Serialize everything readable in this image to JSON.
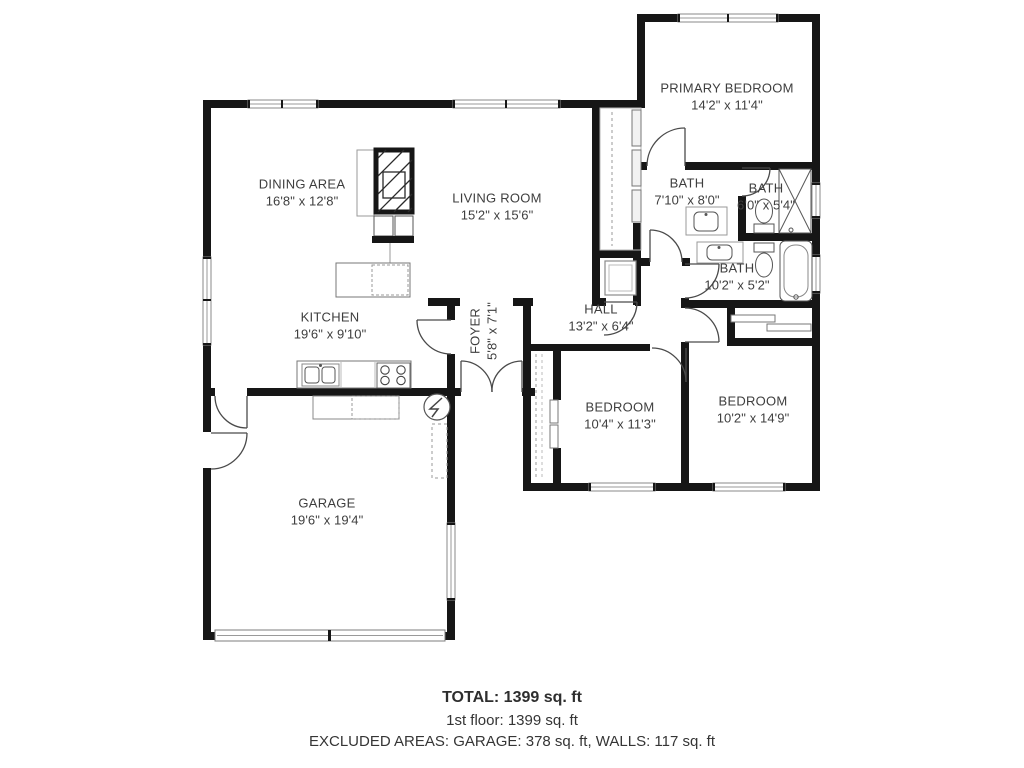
{
  "title": "Floor plan - 1st floor",
  "colors": {
    "wall": "#161616",
    "label_text": "#3e3e3e",
    "fixture_line": "#555555",
    "background": "#ffffff"
  },
  "rooms": {
    "dining": {
      "name": "DINING AREA",
      "dims": "16'8\" x 12'8\""
    },
    "living": {
      "name": "LIVING ROOM",
      "dims": "15'2\" x 15'6\""
    },
    "primary": {
      "name": "PRIMARY BEDROOM",
      "dims": "14'2\" x 11'4\""
    },
    "bath1": {
      "name": "BATH",
      "dims": "7'10\" x 8'0\""
    },
    "bath2": {
      "name": "BATH",
      "dims": "6'0\" x 5'4\""
    },
    "bath3": {
      "name": "BATH",
      "dims": "10'2\" x 5'2\""
    },
    "hall": {
      "name": "HALL",
      "dims": "13'2\" x 6'4\""
    },
    "kitchen": {
      "name": "KITCHEN",
      "dims": "19'6\" x 9'10\""
    },
    "foyer": {
      "name": "FOYER",
      "dims": "5'8\" x 7'1\""
    },
    "bedroom1": {
      "name": "BEDROOM",
      "dims": "10'4\" x 11'3\""
    },
    "bedroom2": {
      "name": "BEDROOM",
      "dims": "10'2\" x 14'9\""
    },
    "garage": {
      "name": "GARAGE",
      "dims": "19'6\" x 19'4\""
    }
  },
  "summary": {
    "total": "TOTAL: 1399 sq. ft",
    "first_floor": "1st floor: 1399 sq. ft",
    "excluded": "EXCLUDED AREAS: GARAGE: 378 sq. ft, WALLS: 117 sq. ft"
  },
  "fixtures": [
    "fireplace",
    "kitchen-sink",
    "stove",
    "water-heater",
    "workbench",
    "bathtub",
    "shower",
    "toilet",
    "vanity-sink",
    "washer",
    "closet-sliding-doors",
    "garage-door",
    "windows",
    "door-swings"
  ]
}
